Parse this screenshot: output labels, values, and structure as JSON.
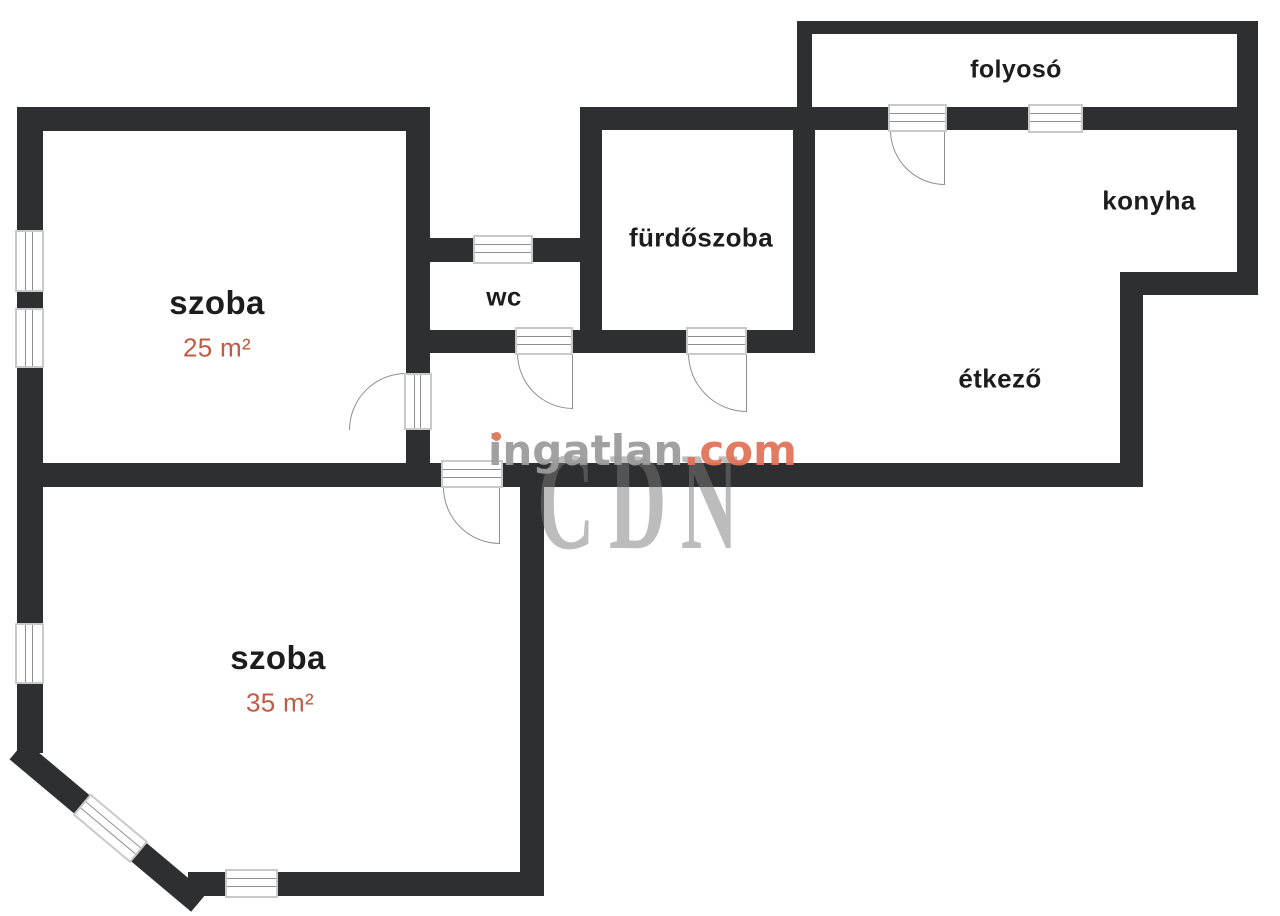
{
  "page": {
    "width": 1280,
    "height": 916,
    "background": "#ffffff"
  },
  "colors": {
    "wall": "#2e2f31",
    "room_text": "#1d1d1e",
    "area_text": "#c05c43",
    "window_frame": "#c9c9c9",
    "symbol_line": "#8f8f8f",
    "logo_gray": "#9c9c9c",
    "logo_orange": "#e2735a",
    "overlay_gray": "#7a7a7a"
  },
  "rooms": {
    "szoba25": {
      "name": "szoba",
      "area": "25 m²"
    },
    "szoba35": {
      "name": "szoba",
      "area": "35 m²"
    },
    "wc": {
      "name": "wc"
    },
    "furdoszoba": {
      "name": "fürdőszoba"
    },
    "folyoso": {
      "name": "folyosó"
    },
    "konyha": {
      "name": "konyha"
    },
    "etkezo": {
      "name": "étkező"
    }
  },
  "watermark": {
    "brand": "ingatlan",
    "tld": ".com",
    "overlay": "CDN"
  },
  "floorplan": {
    "walls": [
      {
        "id": "szoba25-top",
        "x": 17,
        "y": 107,
        "w": 413,
        "h": 24
      },
      {
        "id": "szoba25-left-upper",
        "x": 17,
        "y": 107,
        "w": 26,
        "h": 123
      },
      {
        "id": "szoba25-left-mid",
        "x": 17,
        "y": 292,
        "w": 26,
        "h": 16
      },
      {
        "id": "szoba25-left-lower",
        "x": 17,
        "y": 368,
        "w": 26,
        "h": 119
      },
      {
        "id": "szoba25-right-upper",
        "x": 406,
        "y": 107,
        "w": 24,
        "h": 266
      },
      {
        "id": "szoba25-right-lower",
        "x": 406,
        "y": 430,
        "w": 24,
        "h": 57
      },
      {
        "id": "wc-top-left",
        "x": 406,
        "y": 238,
        "w": 67,
        "h": 24
      },
      {
        "id": "wc-top-right",
        "x": 533,
        "y": 238,
        "w": 69,
        "h": 24
      },
      {
        "id": "wet-bottom-left",
        "x": 406,
        "y": 330,
        "w": 111,
        "h": 23
      },
      {
        "id": "wet-bottom-mid",
        "x": 573,
        "y": 330,
        "w": 115,
        "h": 23
      },
      {
        "id": "wet-bottom-right",
        "x": 747,
        "y": 330,
        "w": 68,
        "h": 23
      },
      {
        "id": "furdoszoba-left",
        "x": 580,
        "y": 107,
        "w": 22,
        "h": 246
      },
      {
        "id": "furdoszoba-right",
        "x": 793,
        "y": 107,
        "w": 22,
        "h": 246
      },
      {
        "id": "band-left",
        "x": 580,
        "y": 107,
        "w": 310,
        "h": 23
      },
      {
        "id": "band-mid",
        "x": 947,
        "y": 107,
        "w": 81,
        "h": 23
      },
      {
        "id": "band-right",
        "x": 1083,
        "y": 107,
        "w": 175,
        "h": 23
      },
      {
        "id": "folyoso-top",
        "x": 797,
        "y": 21,
        "w": 461,
        "h": 13
      },
      {
        "id": "folyoso-left",
        "x": 797,
        "y": 21,
        "w": 15,
        "h": 86
      },
      {
        "id": "right-outer",
        "x": 1237,
        "y": 21,
        "w": 21,
        "h": 274
      },
      {
        "id": "konyha-bottom",
        "x": 1120,
        "y": 272,
        "w": 138,
        "h": 23
      },
      {
        "id": "etkezo-right",
        "x": 1120,
        "y": 272,
        "w": 23,
        "h": 215
      },
      {
        "id": "main-bottom-left",
        "x": 17,
        "y": 463,
        "w": 426,
        "h": 24
      },
      {
        "id": "main-bottom-right",
        "x": 503,
        "y": 463,
        "w": 640,
        "h": 24
      },
      {
        "id": "szoba35-right",
        "x": 520,
        "y": 487,
        "w": 24,
        "h": 409
      },
      {
        "id": "szoba35-left-upper",
        "x": 17,
        "y": 487,
        "w": 26,
        "h": 136
      },
      {
        "id": "szoba35-left-lower",
        "x": 17,
        "y": 684,
        "w": 26,
        "h": 69
      },
      {
        "id": "szoba35-bottom-left",
        "x": 188,
        "y": 872,
        "w": 37,
        "h": 24
      },
      {
        "id": "szoba35-bottom-right",
        "x": 278,
        "y": 872,
        "w": 266,
        "h": 24
      }
    ],
    "windows": [
      {
        "id": "szoba25-window-upper",
        "x": 15,
        "y": 230,
        "w": 29,
        "h": 62,
        "orient": "v"
      },
      {
        "id": "szoba25-window-lower",
        "x": 15,
        "y": 308,
        "w": 29,
        "h": 60,
        "orient": "v"
      },
      {
        "id": "wc-window",
        "x": 473,
        "y": 235,
        "w": 60,
        "h": 29,
        "orient": "h"
      },
      {
        "id": "konyha-window",
        "x": 1028,
        "y": 104,
        "w": 55,
        "h": 29,
        "orient": "h"
      },
      {
        "id": "szoba35-window-left",
        "x": 15,
        "y": 623,
        "w": 29,
        "h": 61,
        "orient": "v"
      },
      {
        "id": "szoba35-window-bottom",
        "x": 225,
        "y": 869,
        "w": 53,
        "h": 29,
        "orient": "h"
      }
    ],
    "doors": [
      {
        "id": "szoba25-door",
        "frame": {
          "x": 404,
          "y": 373,
          "w": 28,
          "h": 57,
          "orient": "v"
        },
        "arc": {
          "x": 349,
          "y": 373,
          "w": 57,
          "h": 57,
          "corner": "tl"
        }
      },
      {
        "id": "wc-door",
        "frame": {
          "x": 515,
          "y": 327,
          "w": 58,
          "h": 28,
          "orient": "h"
        },
        "arc": {
          "x": 517,
          "y": 353,
          "w": 56,
          "h": 56,
          "corner": "bl"
        }
      },
      {
        "id": "furdoszoba-door",
        "frame": {
          "x": 686,
          "y": 327,
          "w": 61,
          "h": 28,
          "orient": "h"
        },
        "arc": {
          "x": 688,
          "y": 353,
          "w": 59,
          "h": 59,
          "corner": "bl"
        }
      },
      {
        "id": "folyoso-door",
        "frame": {
          "x": 888,
          "y": 104,
          "w": 59,
          "h": 28,
          "orient": "h"
        },
        "arc": {
          "x": 890,
          "y": 130,
          "w": 55,
          "h": 55,
          "corner": "bl"
        }
      },
      {
        "id": "szoba35-door",
        "frame": {
          "x": 441,
          "y": 460,
          "w": 62,
          "h": 28,
          "orient": "h"
        },
        "arc": {
          "x": 443,
          "y": 487,
          "w": 57,
          "h": 57,
          "corner": "bl"
        }
      }
    ],
    "diagonal": {
      "x": 25,
      "y": 741,
      "angle_deg": 40,
      "thickness": 24,
      "length": 237,
      "segments": [
        {
          "o": 0,
          "len": 86
        },
        {
          "o": 157,
          "len": 80
        }
      ],
      "window": {
        "o": 84,
        "len": 75
      }
    }
  }
}
